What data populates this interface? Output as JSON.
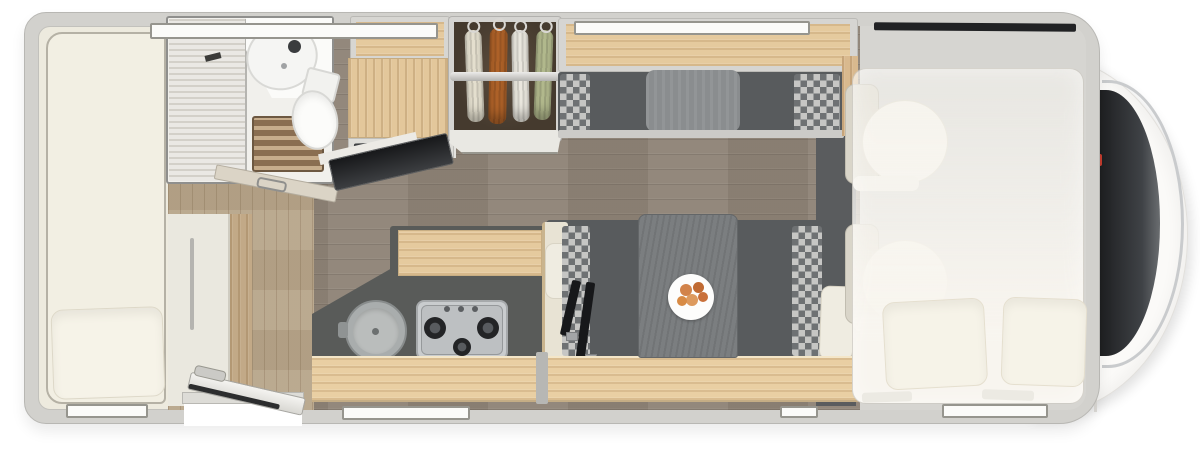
{
  "scene": {
    "subject": "motorhome-floorplan-top-view",
    "counts": {
      "windows": 6,
      "cab_seats": 2,
      "drop_down_bed_pillows": 2,
      "hob_burners": 3,
      "hanging_garments": 4,
      "dinette_seat_belts": 2
    },
    "fixtures": [
      "rear-single-bed",
      "bathroom-shower",
      "washbasin",
      "toilet",
      "tv-flatscreen",
      "fridge-cabinet",
      "wardrobe",
      "overhead-lockers",
      "travel-bench",
      "dinette-table",
      "dinner-plate",
      "kitchen-sink",
      "gas-hob",
      "entry-door-open",
      "cab-seats",
      "drop-down-bed",
      "windshield"
    ]
  },
  "wardrobe": {
    "clothes": [
      {
        "name": "cream-garment",
        "color": "#e9e4d3"
      },
      {
        "name": "orange-garment",
        "color": "#b06329"
      },
      {
        "name": "white-garment",
        "color": "#efece3"
      },
      {
        "name": "green-garment",
        "color": "#b5bc8f"
      }
    ]
  },
  "colors": {
    "page_bg": "#ffffff",
    "body_wall": "#d2d1cd",
    "body_edge": "#b8b7b3",
    "interior": "#edeade",
    "bed": "#f2efe3",
    "pillow": "#f6f3e8",
    "floor_living": "#8f8477",
    "floor_entry": "#b7a58a",
    "wood": "#e5ca9e",
    "wood_dark": "#c2a987",
    "counter": "#595b59",
    "bench_dark": "#585b5d",
    "check_light": "#c6c6c4",
    "check_dark": "#6e7173",
    "cushion_gray": "#8a8d8f",
    "table": "#7b7e80",
    "wardrobe_int": "#453a2e",
    "slat": "#8a6e51",
    "slat_line": "#c7ad8c",
    "fixture_white": "#fbfbf9",
    "glass": "#2a2b2d",
    "chrome": "#c9cbcd",
    "accent_red": "#c43c2e",
    "belt": "#17181a",
    "overlay_bed": "#f8f5ef",
    "dark_zone": "#5a5c5e"
  }
}
